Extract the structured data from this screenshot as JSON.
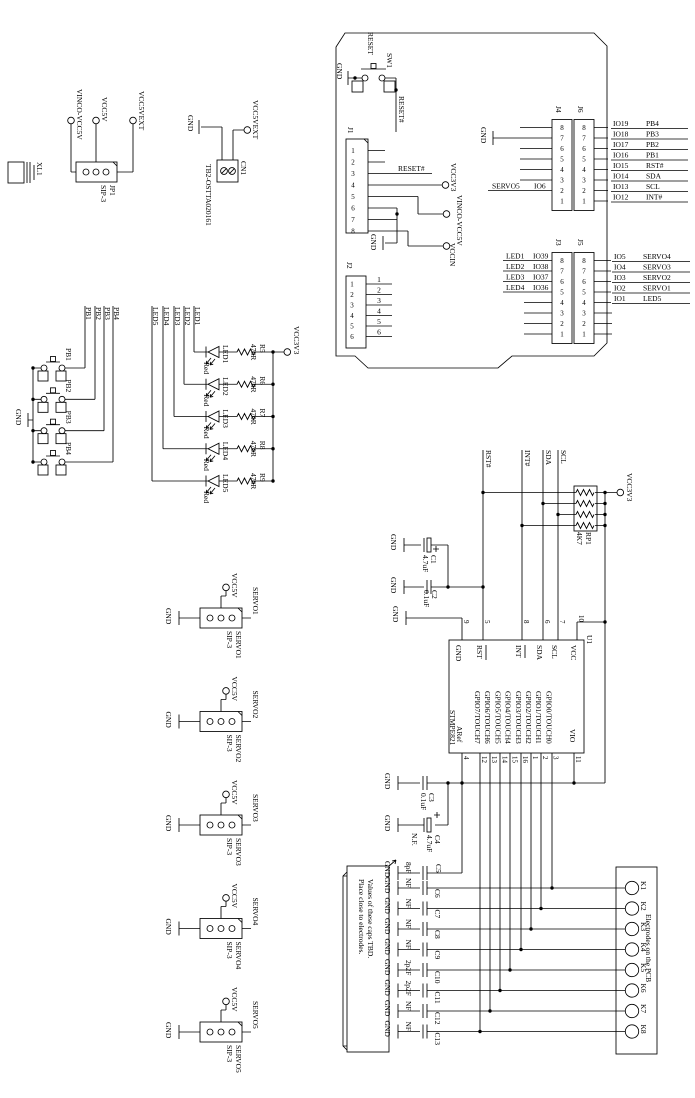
{
  "labels": {
    "gnd": "GND",
    "vcc3v3": "VCC3V3"
  },
  "schematic": {
    "power": {
      "xl1": {
        "ref": "XL1"
      },
      "jp1": {
        "ref": "JP1",
        "type": "SIP-3",
        "net1": "VINCO-VCC5V",
        "net2": "VCC5V",
        "net3": "VCC5VEXT"
      },
      "cn1": {
        "ref": "CN1",
        "part": "TB2-OSTTA020161",
        "net": "VCC5VEXT"
      }
    },
    "board": {
      "sw1": {
        "ref": "SW1",
        "label": "RESET",
        "out": "RESET#"
      },
      "j1": {
        "ref": "J1",
        "pins": [
          "1",
          "2",
          "3",
          "4",
          "5",
          "6",
          "7",
          "8"
        ],
        "reset": "RESET#",
        "vcc3": "VCC3V3",
        "vin": "VINCO-VCC5V",
        "vccin": "VCCIN"
      },
      "j2": {
        "ref": "J2",
        "pins": [
          "1",
          "2",
          "3",
          "4",
          "5",
          "6"
        ],
        "nets": [
          "1",
          "2",
          "3",
          "4",
          "5",
          "6"
        ]
      },
      "hdr_pins": [
        "8",
        "7",
        "6",
        "5",
        "4",
        "3",
        "2",
        "1"
      ],
      "j4": {
        "ref": "J4",
        "servo": "SERVO5",
        "io": "IO6"
      },
      "j6": {
        "ref": "J6",
        "rows": [
          {
            "a": "IO19",
            "b": "PB4"
          },
          {
            "a": "IO18",
            "b": "PB3"
          },
          {
            "a": "IO17",
            "b": "PB2"
          },
          {
            "a": "IO16",
            "b": "PB1"
          },
          {
            "a": "IO15",
            "b": "RST#"
          },
          {
            "a": "IO14",
            "b": "SDA"
          },
          {
            "a": "IO13",
            "b": "SCL"
          },
          {
            "a": "IO12",
            "b": "INT#"
          }
        ]
      },
      "j3": {
        "ref": "J3",
        "rows": [
          {
            "a": "LED1",
            "b": "IO39"
          },
          {
            "a": "LED2",
            "b": "IO38"
          },
          {
            "a": "LED3",
            "b": "IO37"
          },
          {
            "a": "LED4",
            "b": "IO36"
          }
        ]
      },
      "j5": {
        "ref": "J5",
        "rows": [
          {
            "a": "IO5",
            "b": "SERVO4"
          },
          {
            "a": "IO4",
            "b": "SERVO3"
          },
          {
            "a": "IO3",
            "b": "SERVO2"
          },
          {
            "a": "IO2",
            "b": "SERVO1"
          },
          {
            "a": "IO1",
            "b": "LED5"
          }
        ]
      }
    },
    "buttons": {
      "items": [
        {
          "name": "PB1"
        },
        {
          "name": "PB2"
        },
        {
          "name": "PB3"
        },
        {
          "name": "PB4"
        }
      ]
    },
    "leds": {
      "vcc": "VCC3V3",
      "items": [
        {
          "name": "LED1",
          "res": "R5",
          "val": "470R",
          "color": "Red"
        },
        {
          "name": "LED2",
          "res": "R6",
          "val": "470R",
          "color": "Red"
        },
        {
          "name": "LED3",
          "res": "R7",
          "val": "470R",
          "color": "Red"
        },
        {
          "name": "LED4",
          "res": "R8",
          "val": "470R",
          "color": "Red"
        },
        {
          "name": "LED5",
          "res": "R9",
          "val": "470R",
          "color": "Red"
        }
      ]
    },
    "servos": {
      "vcc": "VCC5V",
      "type": "SIP-3",
      "items": [
        {
          "name": "SERVO1"
        },
        {
          "name": "SERVO2"
        },
        {
          "name": "SERVO3"
        },
        {
          "name": "SERVO4"
        },
        {
          "name": "SERVO5"
        }
      ]
    },
    "u1": {
      "ref": "U1",
      "part": "STMPE821",
      "top": [
        {
          "n": "9",
          "name": "GND"
        },
        {
          "n": "5",
          "name": "RST"
        },
        {
          "n": "8",
          "name": "INT"
        },
        {
          "n": "6",
          "name": "SDA"
        },
        {
          "n": "7",
          "name": "SCL"
        },
        {
          "n": "10",
          "name": "VCC"
        }
      ],
      "aref": {
        "n": "4",
        "name": "ARef"
      },
      "vio": {
        "n": "11",
        "name": "VIO"
      },
      "gpio": [
        {
          "n": "12",
          "name": "GPIO7/TOUCH7"
        },
        {
          "n": "13",
          "name": "GPIO6/TOUCH6"
        },
        {
          "n": "14",
          "name": "GPIO5/TOUCH5"
        },
        {
          "n": "15",
          "name": "GPIO4/TOUCH4"
        },
        {
          "n": "16",
          "name": "GPIO3/TOUCH3"
        },
        {
          "n": "1",
          "name": "GPIO2/TOUCH2"
        },
        {
          "n": "2",
          "name": "GPIO1/TOUCH1"
        },
        {
          "n": "3",
          "name": "GPIO0/TOUCH0"
        }
      ]
    },
    "rp1": {
      "ref": "RP1",
      "val": "4K7",
      "rst": "RST#",
      "int": "INT#",
      "sda": "SDA",
      "scl": "SCL"
    },
    "caps": {
      "c1": {
        "ref": "C1",
        "val": "4.7uF"
      },
      "c2": {
        "ref": "C2",
        "val": "0.1uF"
      },
      "c3": {
        "ref": "C3",
        "val": "0.1uF"
      },
      "c4": {
        "ref": "C4",
        "val": "4.7uF",
        "nf": "N.F."
      },
      "c5": {
        "ref": "C5",
        "val": "8pF"
      },
      "rows": [
        {
          "ref": "C6",
          "val": "NF"
        },
        {
          "ref": "C7",
          "val": "NF"
        },
        {
          "ref": "C8",
          "val": "NF"
        },
        {
          "ref": "C9",
          "val": "NF"
        },
        {
          "ref": "C10",
          "val": "2p2F"
        },
        {
          "ref": "C11",
          "val": "2p2F"
        },
        {
          "ref": "C12",
          "val": "NF"
        },
        {
          "ref": "C13",
          "val": "NF"
        }
      ]
    },
    "electrodes": {
      "title": "Electrodes on the PCB",
      "pads": [
        "K1",
        "K2",
        "K3",
        "K4",
        "K5",
        "K6",
        "K7",
        "K8"
      ]
    },
    "note": {
      "line1": "Values of these caps TBD.",
      "line2": "Place close to electrodes."
    }
  }
}
